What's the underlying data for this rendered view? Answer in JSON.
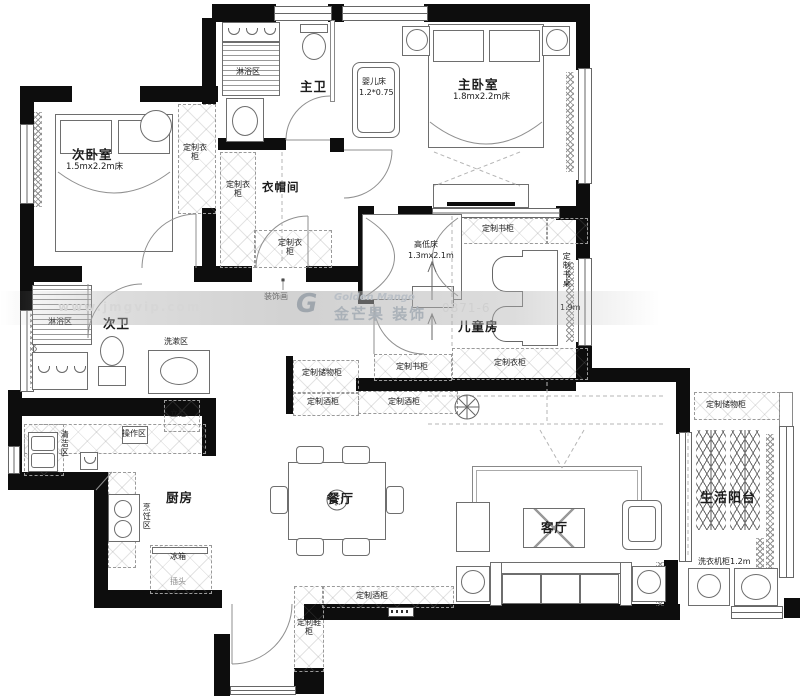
{
  "watermark": {
    "url": "www.jmgvip.com",
    "brand_en": "Golden Mango",
    "brand_cn": "金芒果 装饰",
    "logo_glyph": "G",
    "phone": "0871-6"
  },
  "rooms": {
    "bedroom2": {
      "name": "次卧室",
      "bed_size": "1.5mx2.2m床"
    },
    "master_bedroom": {
      "name": "主卧室",
      "bed_size": "1.8mx2.2m床"
    },
    "master_bath": {
      "name": "主卫"
    },
    "cloakroom": {
      "name": "衣帽间"
    },
    "kids_room": {
      "name": "儿童房"
    },
    "bath2": {
      "name": "次卫"
    },
    "kitchen": {
      "name": "厨房"
    },
    "dining": {
      "name": "餐厅"
    },
    "living": {
      "name": "客厅"
    },
    "balcony": {
      "name": "生活阳台"
    }
  },
  "zones": {
    "shower": "淋浴区",
    "washing": "洗漱区",
    "cleaning": "清洁区",
    "prep": "操作区",
    "cooking": "烹饪区"
  },
  "cabinets": {
    "wardrobe": "定制衣柜",
    "bookcase": "定制书柜",
    "storage": "定制储物柜",
    "wine": "定制酒柜",
    "shoe": "定制鞋柜",
    "tall": "立柜",
    "desk": "定制书桌"
  },
  "furniture": {
    "crib": {
      "name": "婴儿床",
      "size": "1.2*0.75"
    },
    "bunk_bed": {
      "name": "高低床",
      "size": "1.3mx2.1m"
    },
    "desk_length": "1.9m",
    "fridge": "冰箱",
    "plug": "插头",
    "washer_cabinet": "洗衣机柜1.2m",
    "deco_painting": "装饰画"
  }
}
